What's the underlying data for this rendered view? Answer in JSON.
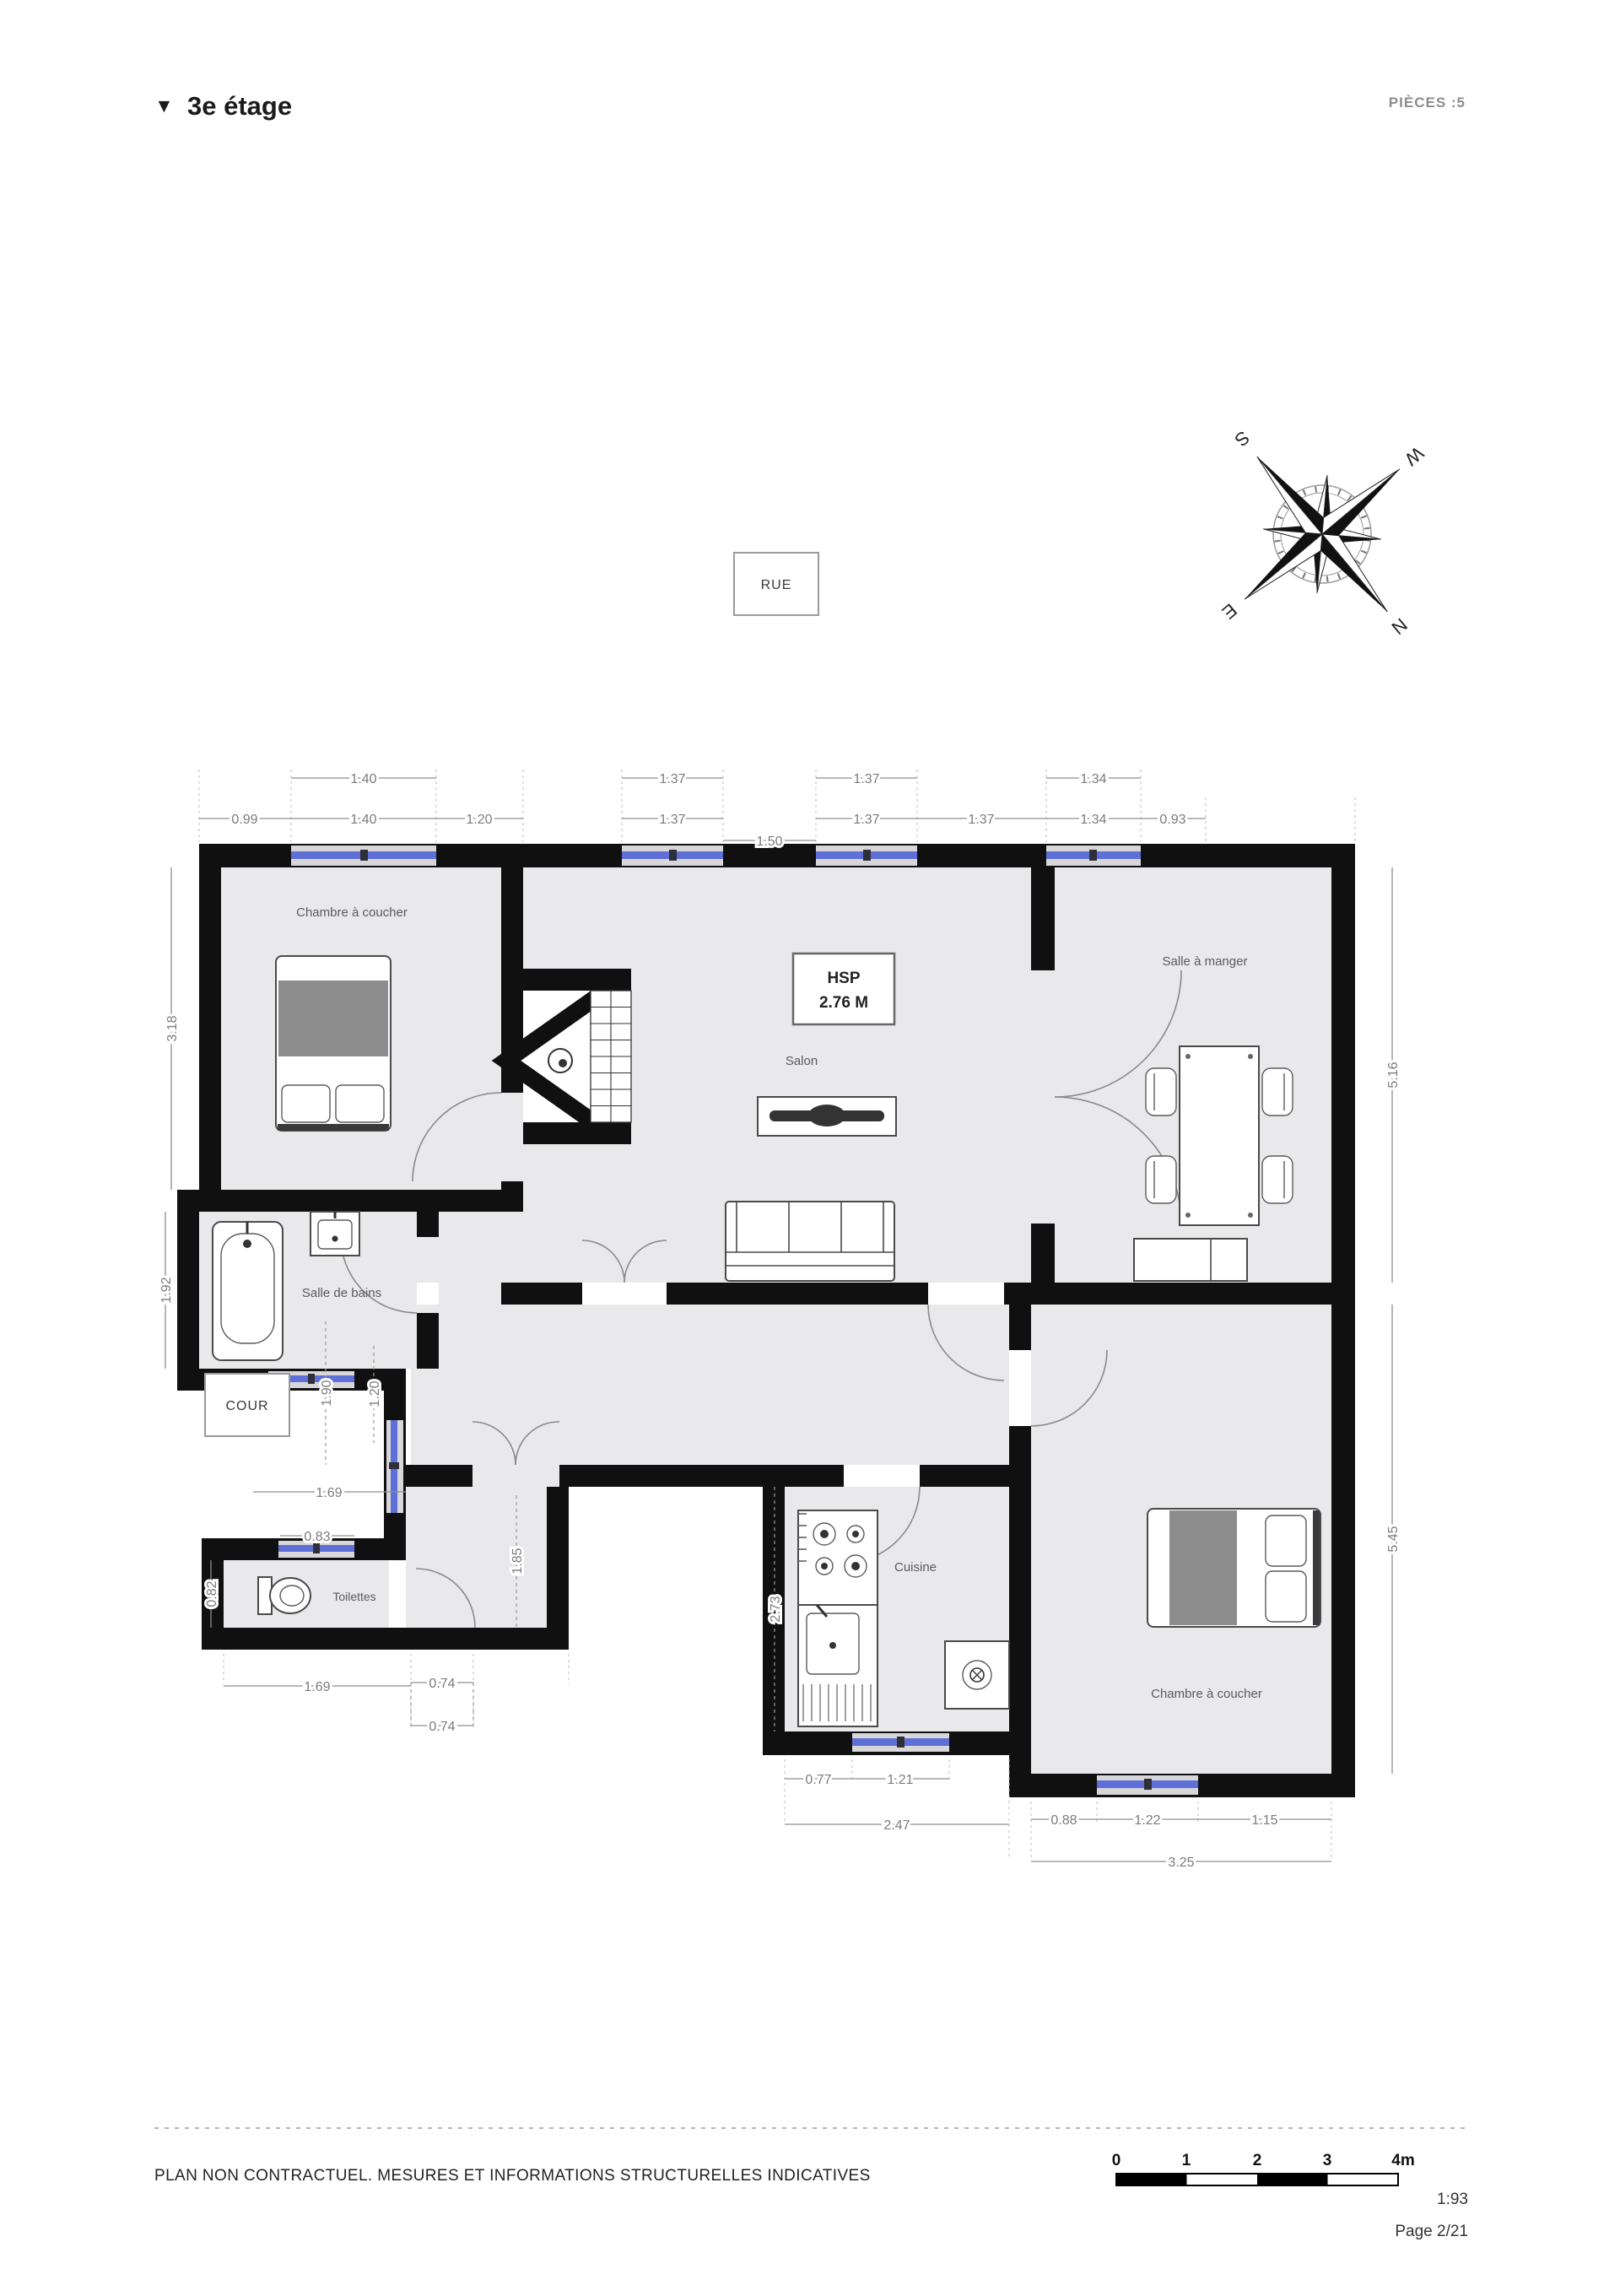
{
  "header": {
    "marker": "▼",
    "title": "3e étage",
    "pieces": "PIÈCES :5"
  },
  "labels": {
    "rue": "RUE",
    "cour": "COUR",
    "hsp_title": "HSP",
    "hsp_value": "2.76 M",
    "bedroom1": "Chambre à coucher",
    "dining": "Salle à manger",
    "salon": "Salon",
    "bathroom": "Salle de bains",
    "toilet": "Toilettes",
    "kitchen": "Cuisine",
    "bedroom2": "Chambre à coucher"
  },
  "compass": {
    "n": "N",
    "e": "E",
    "s": "S",
    "w": "W"
  },
  "dims": {
    "top_outer": [
      "1.40",
      "1.37",
      "1.37",
      "1.34"
    ],
    "top_inner": [
      "0.99",
      "1.40",
      "1.20",
      "1.37",
      "1.50",
      "1.37",
      "1.37",
      "1.34",
      "0.93"
    ],
    "left": [
      "3.18",
      "1.92"
    ],
    "right": [
      "5.16",
      "5.45"
    ],
    "cour": [
      "1.90",
      "1.20",
      "1.69",
      "0.83"
    ],
    "toilet_area": [
      "0.82",
      "1.69",
      "0.74",
      "0.74"
    ],
    "hall": [
      "1.85"
    ],
    "kitchen": [
      "2.73",
      "0.77",
      "1.21",
      "2.47"
    ],
    "bedroom2": [
      "0.88",
      "1.22",
      "1.15",
      "3.25"
    ]
  },
  "footer": {
    "disclaimer": "PLAN NON CONTRACTUEL. MESURES ET INFORMATIONS STRUCTURELLES INDICATIVES",
    "ticks": [
      "0",
      "1",
      "2",
      "3",
      "4m"
    ],
    "ratio": "1:93",
    "page": "Page 2/21"
  },
  "colors": {
    "wall": "#101010",
    "floor": "#e9e9eb",
    "window": "#5f6fd8",
    "dim": "#7c7c7c"
  }
}
